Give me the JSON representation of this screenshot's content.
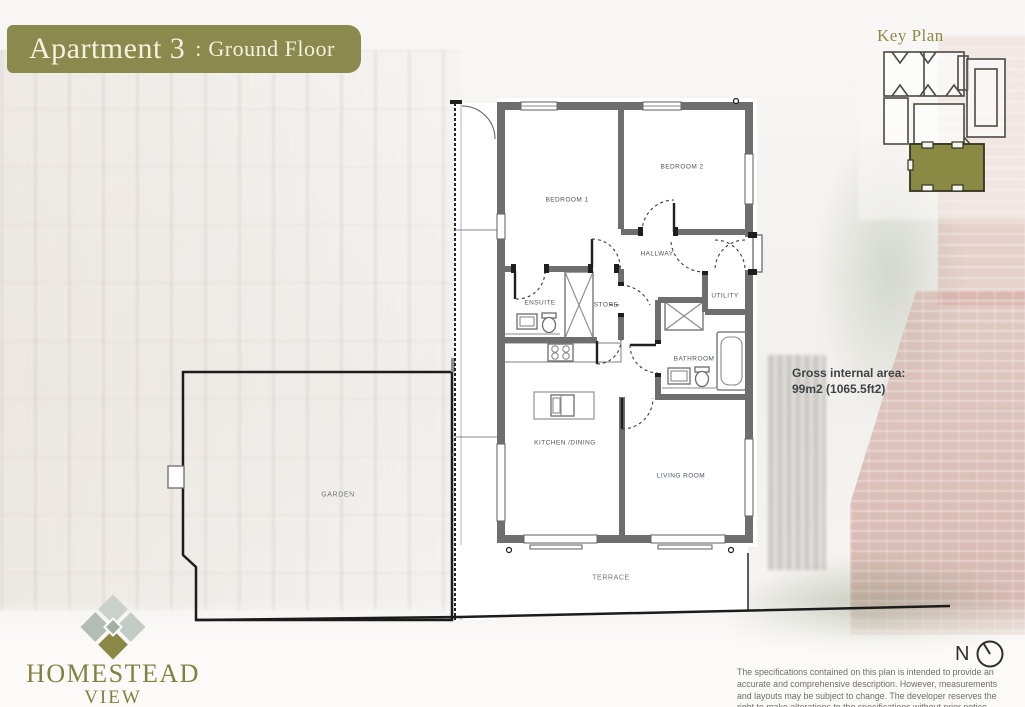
{
  "header": {
    "title_main": "Apartment 3",
    "title_separator": ":",
    "title_sub": "Ground Floor"
  },
  "key_plan": {
    "label": "Key Plan"
  },
  "rooms": {
    "bedroom1": "BEDROOM 1",
    "bedroom2": "BEDROOM 2",
    "hallway": "HALLWAY",
    "ensuite": "ENSUITE",
    "store": "STORE",
    "utility": "UTILITY",
    "bathroom": "BATHROOM",
    "kitchen_dining": "KITCHEN /DINING",
    "living_room": "LIVING ROOM",
    "garden": "GARDEN",
    "terrace": "TERRACE"
  },
  "area": {
    "line1": "Gross internal area:",
    "line2": "99m2 (1065.5ft2)"
  },
  "brand": {
    "name_line1": "HOMESTEAD",
    "name_line2": "VIEW"
  },
  "compass": {
    "label": "N"
  },
  "disclaimer": {
    "lines": [
      "The specifications contained on this plan is intended to provide an",
      "accurate and comprehensive description. However, measurements",
      "and layouts may be subject to change. The developer reserves the",
      "right to make alterations to the specifications without prior notice."
    ]
  },
  "colors": {
    "olive": "#8B8A4E",
    "banner_text": "#F5F1DC",
    "key_plan_olive": "#8A8A45",
    "wall": "#6E6E6E",
    "plan_line": "#1C1C1C",
    "label_text": "#4C525C",
    "outdoor_label": "#6F747A",
    "area_text": "#3E4347",
    "disclaimer_text": "#6E6E6E",
    "brand_olive": "#83813F"
  }
}
